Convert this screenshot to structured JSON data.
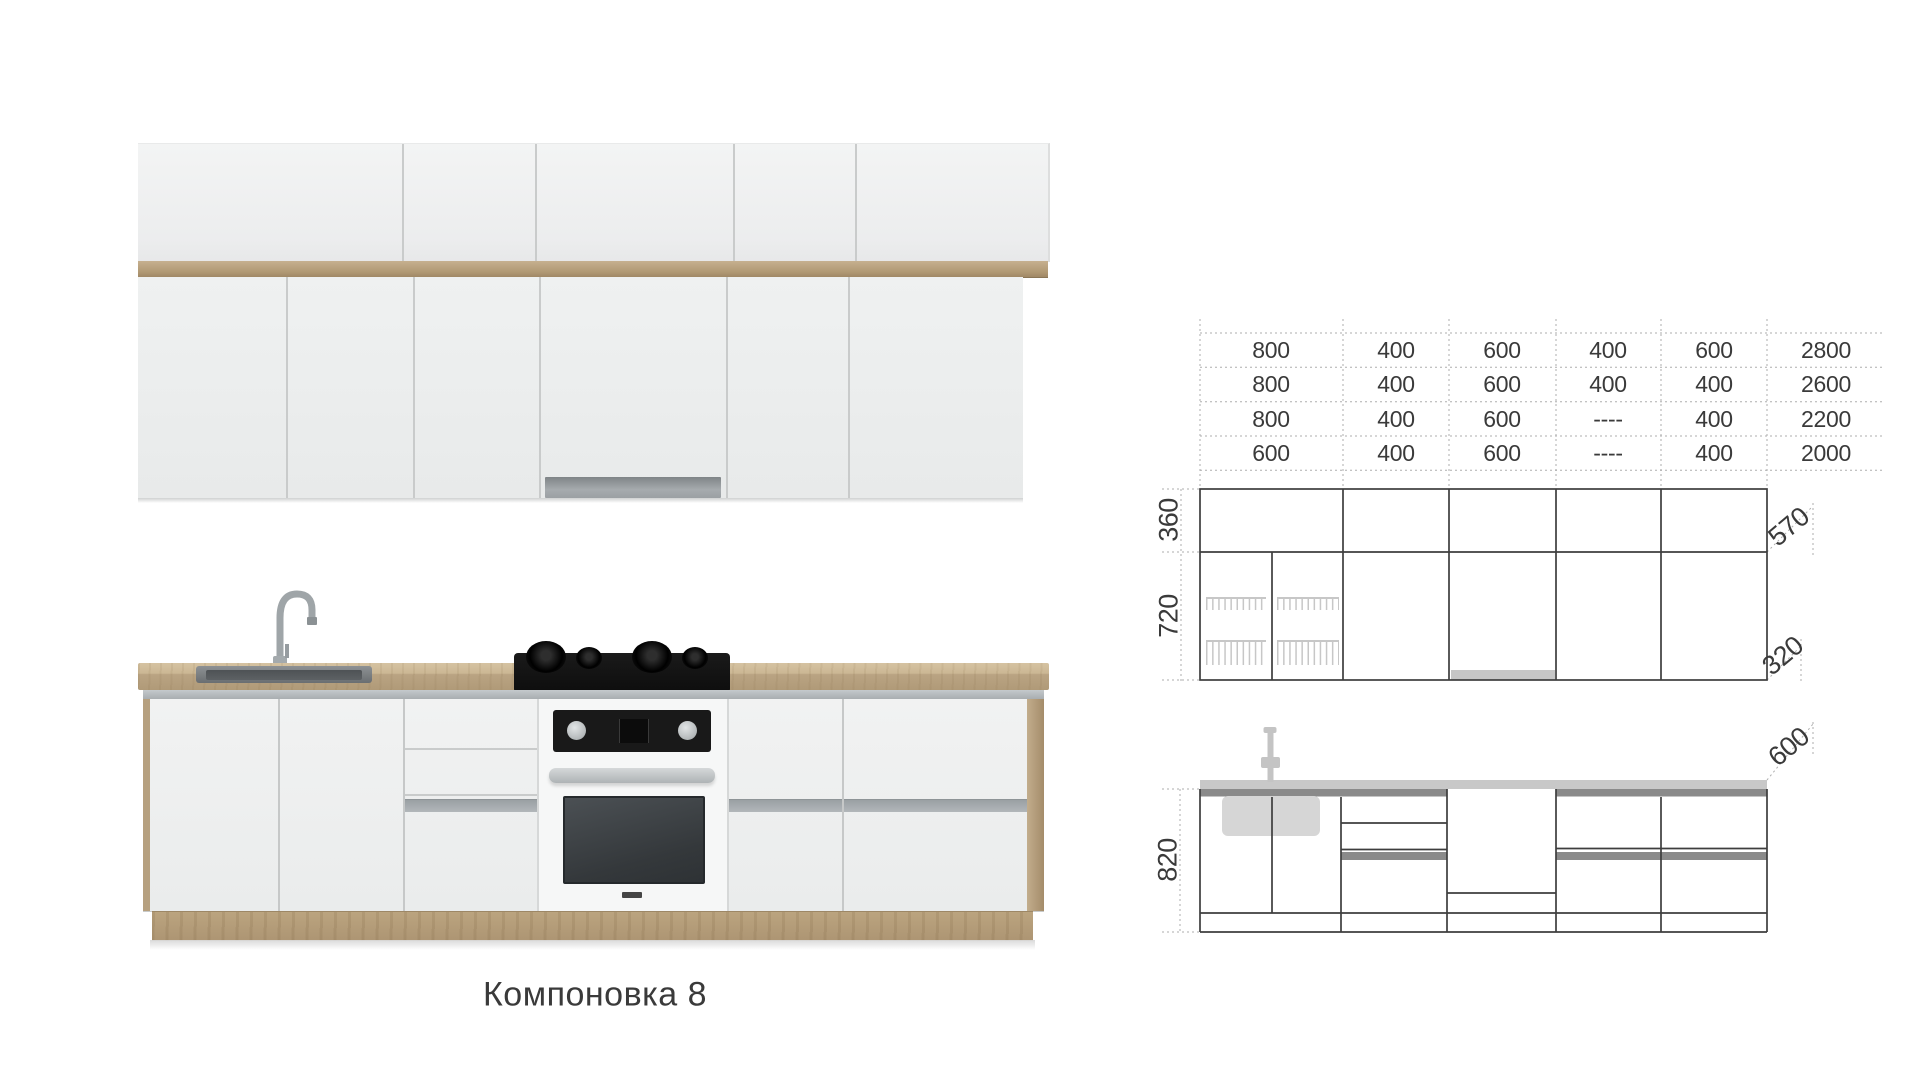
{
  "caption": "Компоновка 8",
  "table": {
    "rows": [
      [
        "800",
        "400",
        "600",
        "400",
        "600",
        "2800"
      ],
      [
        "800",
        "400",
        "600",
        "400",
        "400",
        "2600"
      ],
      [
        "800",
        "400",
        "600",
        "----",
        "400",
        "2200"
      ],
      [
        "600",
        "400",
        "600",
        "----",
        "400",
        "2000"
      ]
    ]
  },
  "dims": {
    "wall_top_height": "360",
    "wall_bottom_height": "720",
    "wall_top_depth": "570",
    "wall_bottom_depth": "320",
    "base_height": "820",
    "counter_depth": "600"
  },
  "colors": {
    "text": "#3a3a3a",
    "drawing_line": "#3e3e3e",
    "schematic_gray": "#c8c8c8",
    "schematic_dark_gray": "#8a8a8a",
    "wood": "#b49d7b",
    "door_white": "#eff0f0",
    "steel_gray": "#aab0b3",
    "oven_black": "#191919"
  }
}
